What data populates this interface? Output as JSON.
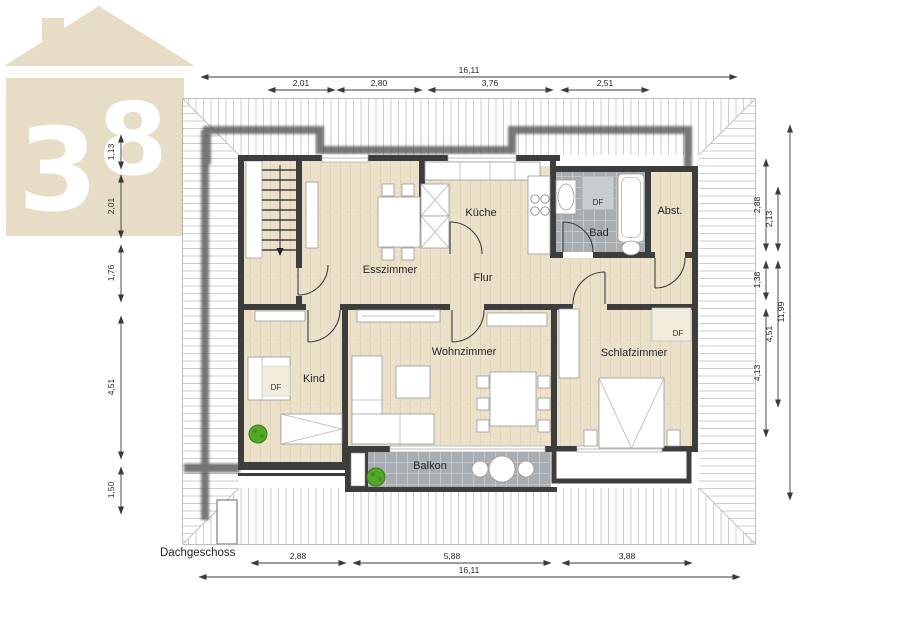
{
  "title": "Dachgeschoss",
  "logo": {
    "digit1": "3",
    "digit2": "8"
  },
  "labels": {
    "esszimmer": "Esszimmer",
    "kueche": "Küche",
    "bad": "Bad",
    "abstellraum": "Abst.",
    "flur": "Flur",
    "kind": "Kind",
    "wohnzimmer": "Wohnzimmer",
    "schlafzimmer": "Schlafzimmer",
    "balkon": "Balkon",
    "df": "DF"
  },
  "dimensions": {
    "top": {
      "overall": "16,11",
      "segments": [
        "2,01",
        "2,80",
        "3,76",
        "2,51"
      ]
    },
    "bottom": {
      "overall": "16,11",
      "segments": [
        "2,88",
        "5,88",
        "3,88"
      ]
    },
    "left": {
      "segments": [
        "1,13",
        "2,01",
        "1,76",
        "4,51",
        "1,50"
      ]
    },
    "right": {
      "overall": "11,99",
      "chain_a": [
        "2,88",
        "1,38",
        "4,13"
      ],
      "chain_b": [
        "2,13",
        "4,51"
      ]
    }
  },
  "colors": {
    "wall": "#3d3d3d",
    "wood_floor": "#ebe1cb",
    "tile_floor": "#a8adb1",
    "logo_beige": "#e7ddc6",
    "plant_green": "#54a829",
    "hatch_line": "#cdcdcd"
  }
}
